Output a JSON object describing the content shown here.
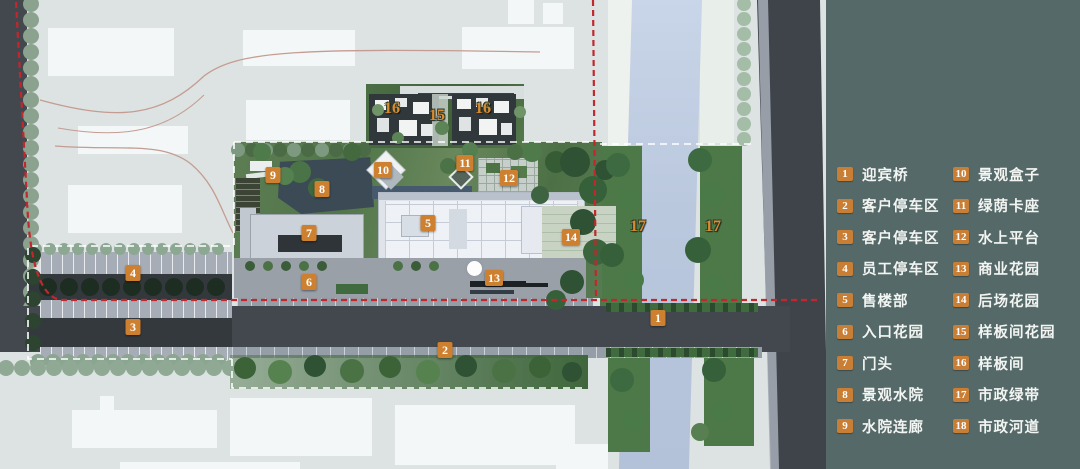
{
  "title": "landscape-site-plan",
  "legend": {
    "columns": [
      [
        {
          "num": "1",
          "label": "迎宾桥"
        },
        {
          "num": "2",
          "label": "客户停车区"
        },
        {
          "num": "3",
          "label": "客户停车区"
        },
        {
          "num": "4",
          "label": "员工停车区"
        },
        {
          "num": "5",
          "label": "售楼部"
        },
        {
          "num": "6",
          "label": "入口花园"
        },
        {
          "num": "7",
          "label": "门头"
        },
        {
          "num": "8",
          "label": "景观水院"
        },
        {
          "num": "9",
          "label": "水院连廊"
        }
      ],
      [
        {
          "num": "10",
          "label": "景观盒子"
        },
        {
          "num": "11",
          "label": "绿荫卡座"
        },
        {
          "num": "12",
          "label": "水上平台"
        },
        {
          "num": "13",
          "label": "商业花园"
        },
        {
          "num": "14",
          "label": "后场花园"
        },
        {
          "num": "15",
          "label": "样板间花园"
        },
        {
          "num": "16",
          "label": "样板间"
        },
        {
          "num": "17",
          "label": "市政绿带"
        },
        {
          "num": "18",
          "label": "市政河道"
        }
      ]
    ]
  },
  "map": {
    "markers": [
      {
        "num": "1",
        "x": 658,
        "y": 318,
        "style": "box"
      },
      {
        "num": "2",
        "x": 445,
        "y": 350,
        "style": "box"
      },
      {
        "num": "3",
        "x": 133,
        "y": 327,
        "style": "box"
      },
      {
        "num": "4",
        "x": 133,
        "y": 273,
        "style": "box"
      },
      {
        "num": "5",
        "x": 428,
        "y": 223,
        "style": "box"
      },
      {
        "num": "6",
        "x": 309,
        "y": 282,
        "style": "box"
      },
      {
        "num": "7",
        "x": 309,
        "y": 233,
        "style": "box"
      },
      {
        "num": "8",
        "x": 322,
        "y": 189,
        "style": "box"
      },
      {
        "num": "9",
        "x": 273,
        "y": 175,
        "style": "box"
      },
      {
        "num": "10",
        "x": 383,
        "y": 170,
        "style": "box"
      },
      {
        "num": "11",
        "x": 465,
        "y": 163,
        "style": "box"
      },
      {
        "num": "12",
        "x": 509,
        "y": 178,
        "style": "box"
      },
      {
        "num": "13",
        "x": 494,
        "y": 278,
        "style": "box"
      },
      {
        "num": "14",
        "x": 571,
        "y": 237,
        "style": "box"
      },
      {
        "num": "15",
        "x": 437,
        "y": 116,
        "style": "text"
      },
      {
        "num": "16",
        "x": 392,
        "y": 109,
        "style": "text"
      },
      {
        "num": "16",
        "x": 483,
        "y": 109,
        "style": "text"
      },
      {
        "num": "17",
        "x": 638,
        "y": 227,
        "style": "text"
      },
      {
        "num": "17",
        "x": 713,
        "y": 227,
        "style": "text"
      }
    ]
  },
  "colors": {
    "marker_orange": "#cd8030",
    "legend_background": "#546968",
    "boundary_red": "#c1272d",
    "site_boundary_white": "#ffffff",
    "river_blue": "#bac8de",
    "road_gray": "#43484f"
  }
}
